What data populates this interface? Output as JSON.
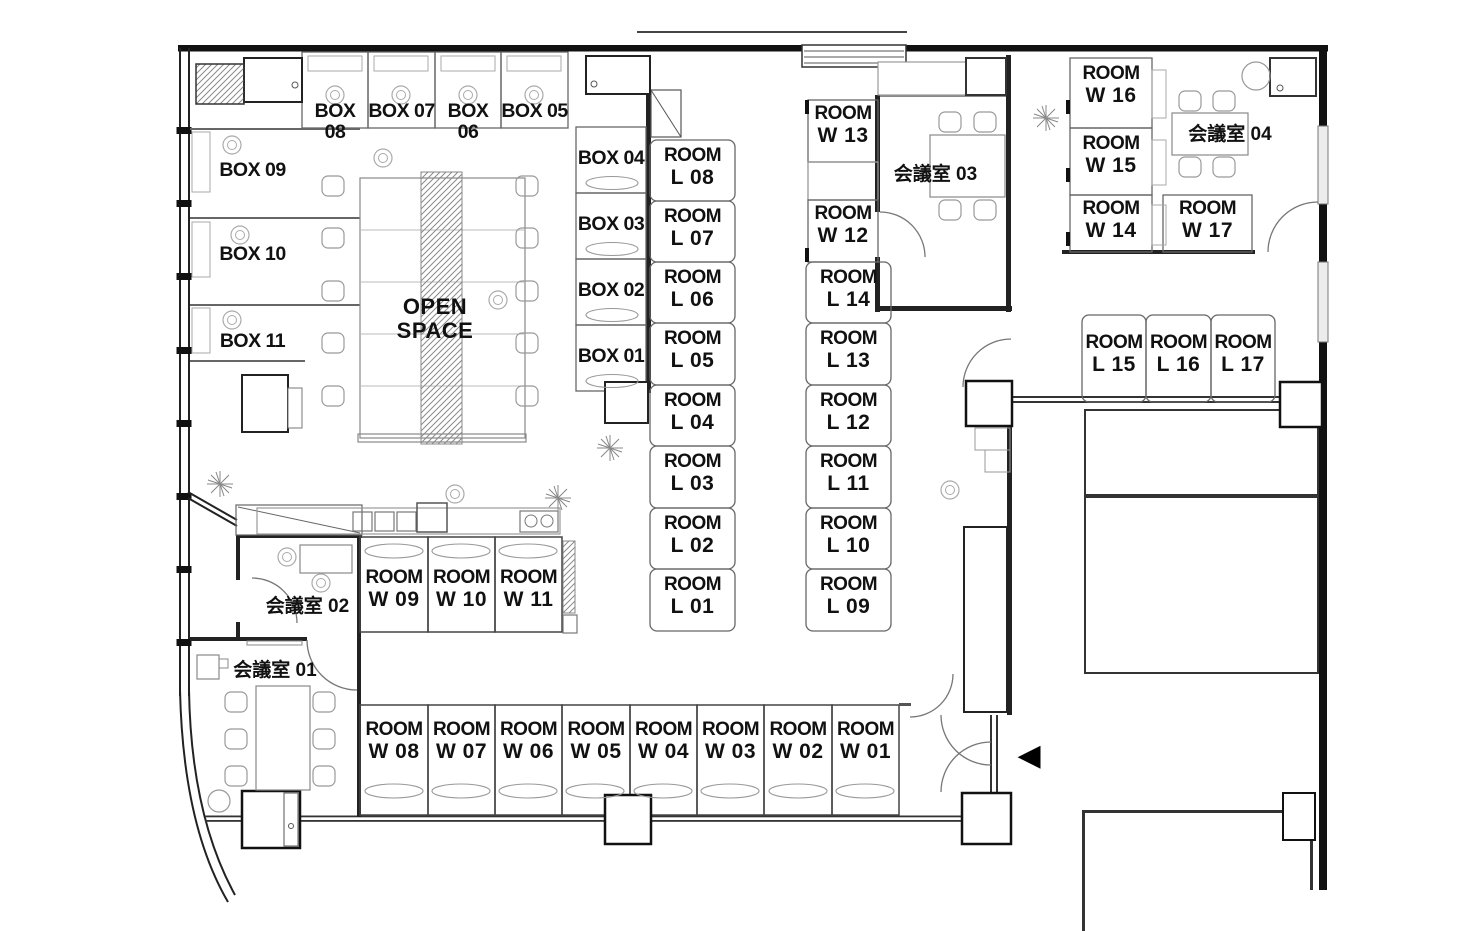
{
  "plan": {
    "open_space": "OPEN SPACE",
    "room_word": "ROOM",
    "entrance_arrow": "◀"
  },
  "boxes": {
    "b01": "BOX 01",
    "b02": "BOX 02",
    "b03": "BOX 03",
    "b04": "BOX 04",
    "b05": "BOX 05",
    "b06": "BOX 06",
    "b07": "BOX 07",
    "b08": "BOX 08",
    "b09": "BOX 09",
    "b10": "BOX 10",
    "b11": "BOX 11"
  },
  "l_rooms": {
    "l01": "L 01",
    "l02": "L 02",
    "l03": "L 03",
    "l04": "L 04",
    "l05": "L 05",
    "l06": "L 06",
    "l07": "L 07",
    "l08": "L 08",
    "l09": "L 09",
    "l10": "L 10",
    "l11": "L 11",
    "l12": "L 12",
    "l13": "L 13",
    "l14": "L 14",
    "l15": "L 15",
    "l16": "L 16",
    "l17": "L 17"
  },
  "w_rooms": {
    "w01": "W 01",
    "w02": "W 02",
    "w03": "W 03",
    "w04": "W 04",
    "w05": "W 05",
    "w06": "W 06",
    "w07": "W 07",
    "w08": "W 08",
    "w09": "W 09",
    "w10": "W 10",
    "w11": "W 11",
    "w12": "W 12",
    "w13": "W 13",
    "w14": "W 14",
    "w15": "W 15",
    "w16": "W 16",
    "w17": "W 17"
  },
  "meeting_rooms": {
    "m01": "会議室 01",
    "m02": "会議室 02",
    "m03": "会議室 03",
    "m04": "会議室 04"
  }
}
